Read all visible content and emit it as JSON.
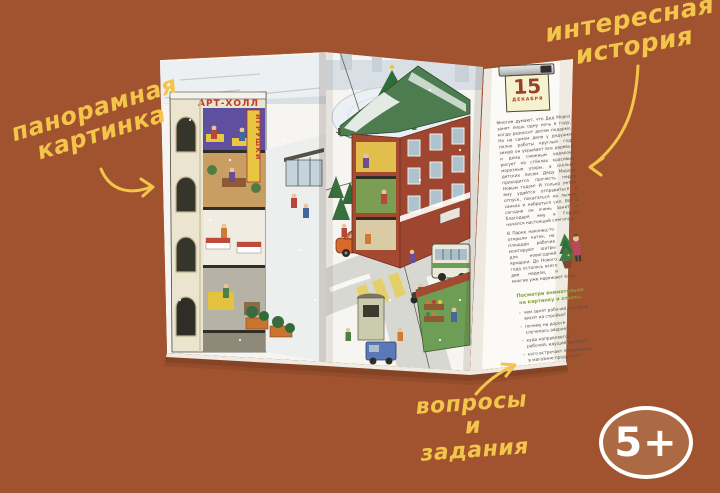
{
  "colors": {
    "background": "#A1532F",
    "accent_yellow": "#F3C54A",
    "badge_fill": "#AC6A44",
    "badge_border": "#FFFFFF"
  },
  "annotations": {
    "panoramic": {
      "line1": "панорамная",
      "line2": "картинка"
    },
    "story": {
      "line1": "интересная",
      "line2": "история"
    },
    "tasks": {
      "line1": "вопросы",
      "line2": "и задания"
    }
  },
  "age_badge": "5+",
  "book": {
    "signs": {
      "building": "АРТ-ХОЛЛ",
      "vertical": "ИГРУШКИ"
    },
    "calendar": {
      "day": "15",
      "month": "декабря"
    },
    "story": {
      "p1": "Многие думают, что Дед Мороз занят лишь одну ночь в году, когда разносит детям подарки. Но на самом деле у дедушки полно работы круглый год: зимой он укрывает все деревья и дома снежным одеялом, рисует на стёклах красивые морозные узоры, а сколько детских писем Деду Морозу приходится прочесть перед Новым годом! И только летом ему удаётся отправиться в отпуск, покататься на лыжах, санках и набраться сил. Вот и сегодня он очень занят — благодаря ему в Городе начался настоящий снегопад.",
      "p2": "В Парке наконец-то открыли каток, на площади рабочие монтируют шатры для новогодней ярмарки. До Нового года осталось всего две недели, и многие уже наряжают ёлку."
    },
    "questions_heading": "Посмотри внимательно на картинку и ответь:",
    "questions": [
      "чем занят рабочий, который висит на стройке?",
      "почему на дороге случилась авария?",
      "куда направляется рабочий, идущий на обед?",
      "кого встречает продавщица в магазине продуктов?"
    ]
  }
}
